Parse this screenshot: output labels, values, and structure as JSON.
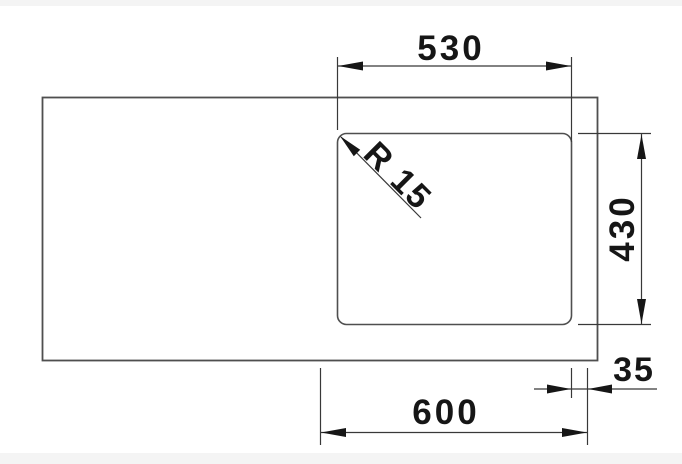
{
  "window": {
    "background": "#ffffff",
    "frame_bar_color": "#f4f4f4"
  },
  "drawing": {
    "kind": "technical-dimension-drawing-top-view",
    "colors": {
      "object_line": "#4f4f4f",
      "dimension_line": "#383838",
      "ink": "#161616"
    },
    "dimensions": {
      "bowl_width": {
        "label": "530",
        "orientation": "horizontal-top"
      },
      "bowl_depth": {
        "label": "430",
        "orientation": "vertical-right"
      },
      "cabinet_width": {
        "label": "600",
        "orientation": "horizontal-bottom"
      },
      "edge_offset": {
        "label": "35",
        "orientation": "horizontal-bottom-right"
      },
      "corner_radius": {
        "label": "R 15",
        "orientation": "diagonal-45"
      }
    }
  }
}
